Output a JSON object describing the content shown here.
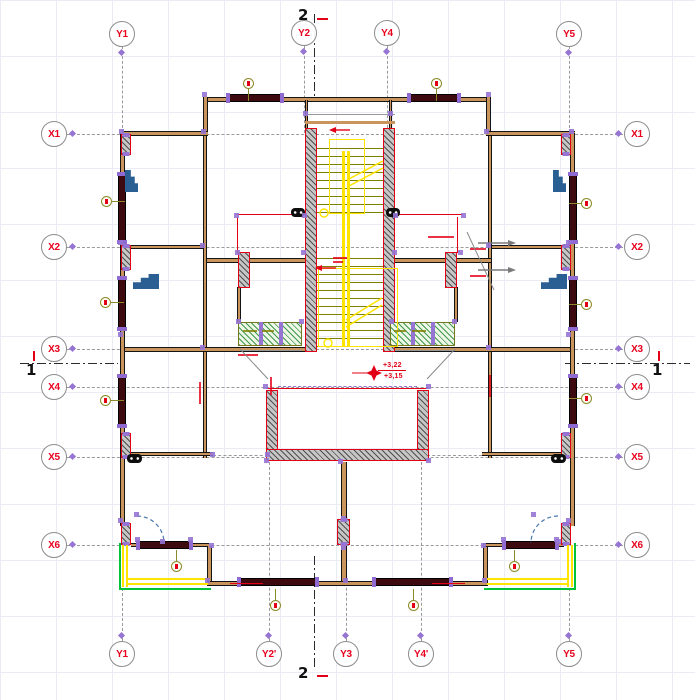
{
  "axes": {
    "top": [
      "Y1",
      "Y2",
      "Y4",
      "Y5"
    ],
    "bottom": [
      "Y1",
      "Y2'",
      "Y3",
      "Y4'",
      "Y5"
    ],
    "left": [
      "X1",
      "X2",
      "X3",
      "X4",
      "X5",
      "X6"
    ],
    "right": [
      "X1",
      "X2",
      "X3",
      "X4",
      "X5",
      "X6"
    ]
  },
  "sections": {
    "vertical_label": "2",
    "horizontal_label": "1"
  },
  "levels": {
    "upper": "+3,22",
    "lower": "+3,15"
  },
  "colors": {
    "axis_text": "#e8001c",
    "grid_dash": "#9a9a9a",
    "wall_core": "#c9955c",
    "window_fill": "#3d0a10",
    "concrete_hatch_border": "#e30016",
    "grip_purple": "#9674d4",
    "stair_yellow": "#ffe400",
    "tread_olive": "#7f7f00",
    "balcony_green": "#00c33c",
    "door_arc_blue": "#4879b0",
    "planter_green": "#3f9a4c"
  }
}
